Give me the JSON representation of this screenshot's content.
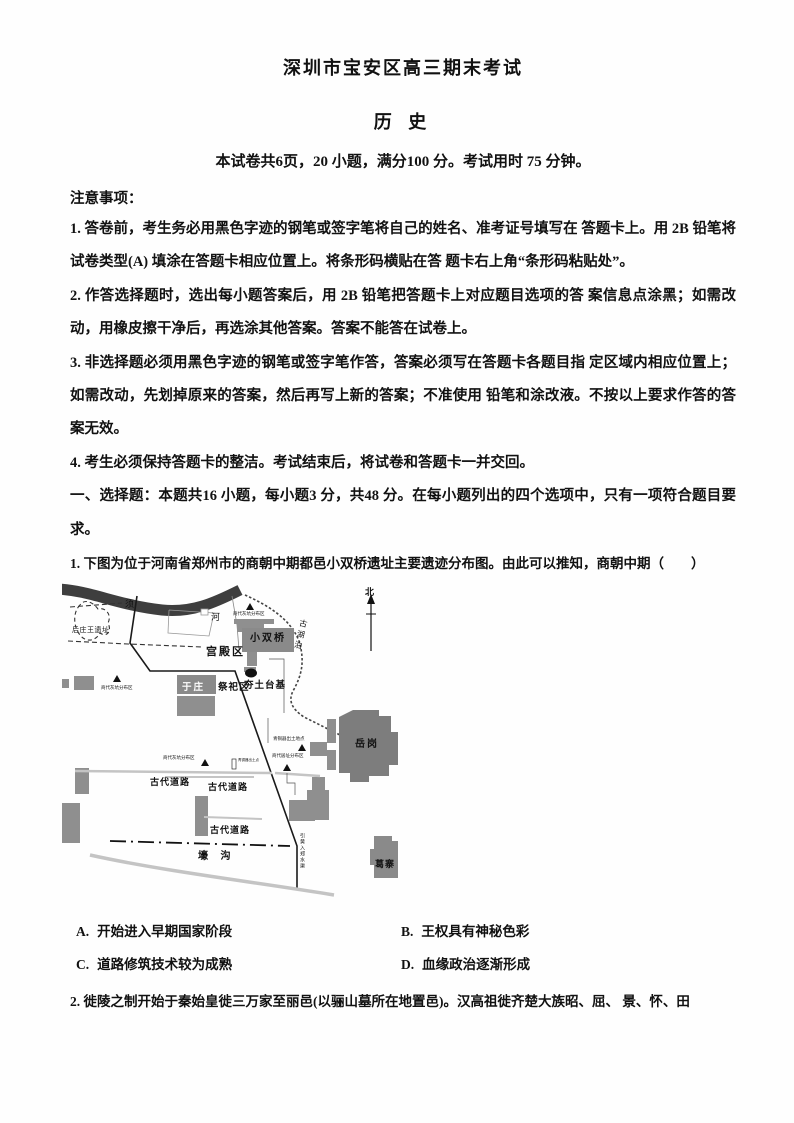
{
  "header": {
    "title": "深圳市宝安区高三期末考试",
    "subject": "历 史",
    "exam_info": "本试卷共6页，20 小题，满分100 分。考试用时 75 分钟。"
  },
  "notices": {
    "heading": "注意事项：",
    "items": [
      "1. 答卷前，考生务必用黑色字迹的钢笔或签字笔将自己的姓名、准考证号填写在 答题卡上。用 2B 铅笔将试卷类型(A) 填涂在答题卡相应位置上。将条形码横贴在答 题卡右上角“条形码粘贴处”。",
      "2. 作答选择题时，选出每小题答案后，用 2B 铅笔把答题卡上对应题目选项的答 案信息点涂黑；如需改动，用橡皮擦干净后，再选涂其他答案。答案不能答在试卷上。",
      "3. 非选择题必须用黑色字迹的钢笔或签字笔作答，答案必须写在答题卡各题目指 定区域内相应位置上；如需改动，先划掉原来的答案，然后再写上新的答案；不准使用 铅笔和涂改液。不按以上要求作答的答案无效。",
      "4. 考生必须保持答题卡的整洁。考试结束后，将试卷和答题卡一并交回。"
    ]
  },
  "section1": {
    "heading": "一、选择题：本题共16 小题，每小题3 分，共48 分。在每小题列出的四个选项中，只有一项符合题目要求。"
  },
  "q1": {
    "text": "1. 下图为位于河南省郑州市的商朝中期都邑小双桥遗址主要遗迹分布图。由此可以推知，商朝中期（　　）",
    "options": [
      {
        "label": "A.",
        "text": "开始进入早期国家阶段"
      },
      {
        "label": "B.",
        "text": "王权具有神秘色彩"
      },
      {
        "label": "C.",
        "text": "道路修筑技术较为成熟"
      },
      {
        "label": "D.",
        "text": "血缘政治逐渐形成"
      }
    ]
  },
  "q2": {
    "text": "2. 徙陵之制开始于秦始皇徙三万家至丽邑(以骊山墓所在地置邑)。汉高祖徙齐楚大族昭、屈、 景、怀、田"
  },
  "map": {
    "colors": {
      "river": "#3e3e3e",
      "block": "#8f8f8f",
      "dark_block": "#7d7d7d",
      "road": "#c4c4c4"
    },
    "labels": [
      {
        "text": "须"
      },
      {
        "text": "河"
      },
      {
        "text": "后庄王遗址"
      },
      {
        "text": "商代灰坑分布区"
      },
      {
        "text": "小双桥"
      },
      {
        "text": "宫殿区"
      },
      {
        "text": "夯土台基"
      },
      {
        "text": "于庄"
      },
      {
        "text": "祭祀区"
      },
      {
        "text": "商代灰坑分布区"
      },
      {
        "text": "古湖泊"
      },
      {
        "text": "北"
      },
      {
        "text": "青铜器出土地点"
      },
      {
        "text": "商代居址分布区"
      },
      {
        "text": "商代灰坑分布区"
      },
      {
        "text": "青铜器出土点"
      },
      {
        "text": "古代道路"
      },
      {
        "text": "古代道路"
      },
      {
        "text": "古代道路"
      },
      {
        "text": "壕 沟"
      },
      {
        "text": "岳岗"
      },
      {
        "text": "葛寨"
      },
      {
        "text": "引黄入郑水渠"
      }
    ]
  }
}
